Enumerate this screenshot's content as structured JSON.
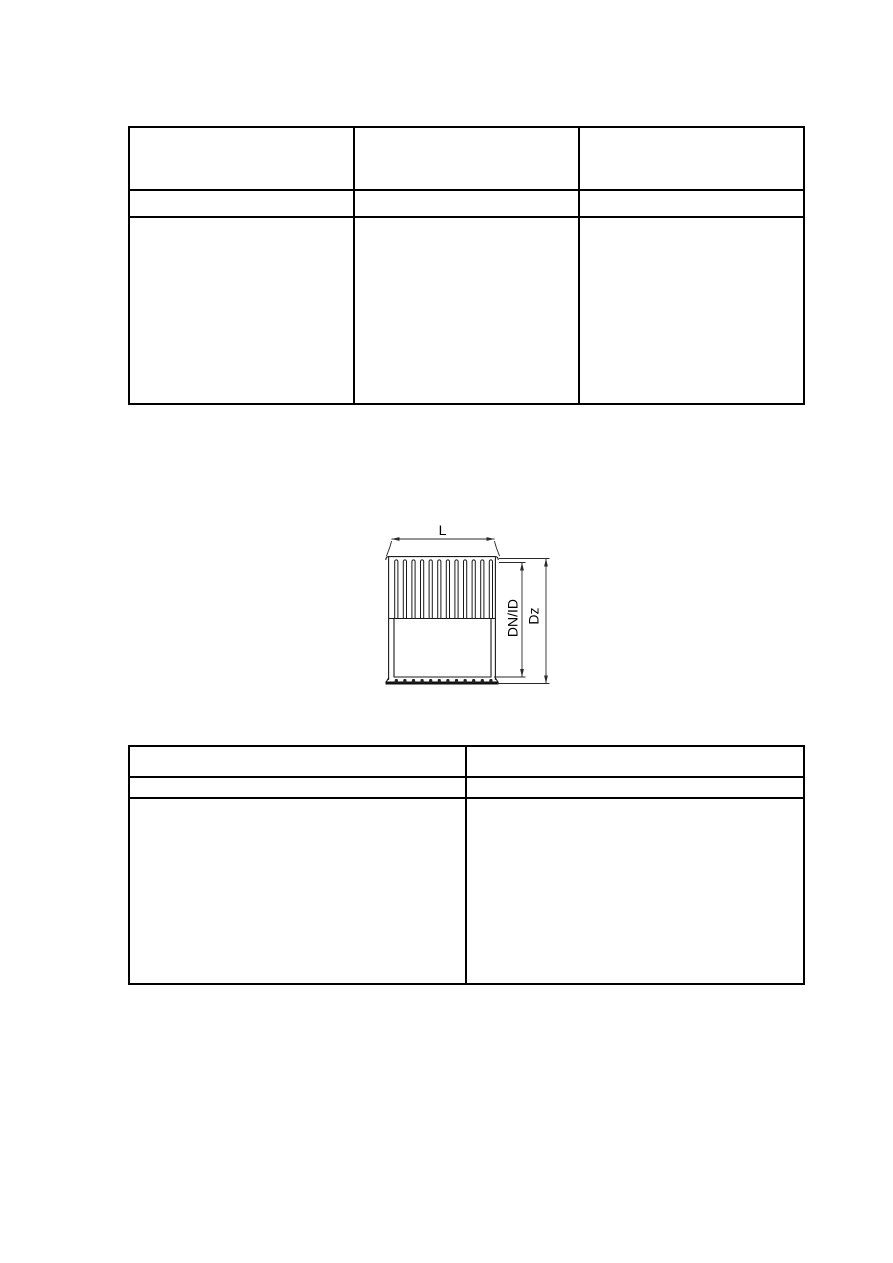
{
  "drawing": {
    "dimension_labels": {
      "length": "L",
      "inner_diameter": "DN/ID",
      "outer_diameter": "Dz"
    },
    "ink_color": "#1a1a1a"
  },
  "tables": {
    "top": {
      "rows": [
        [
          "",
          "",
          ""
        ],
        [
          "",
          "",
          ""
        ],
        [
          "",
          "",
          ""
        ]
      ]
    },
    "bottom": {
      "rows": [
        [
          "",
          ""
        ],
        [
          "",
          ""
        ],
        [
          "",
          ""
        ]
      ]
    }
  }
}
